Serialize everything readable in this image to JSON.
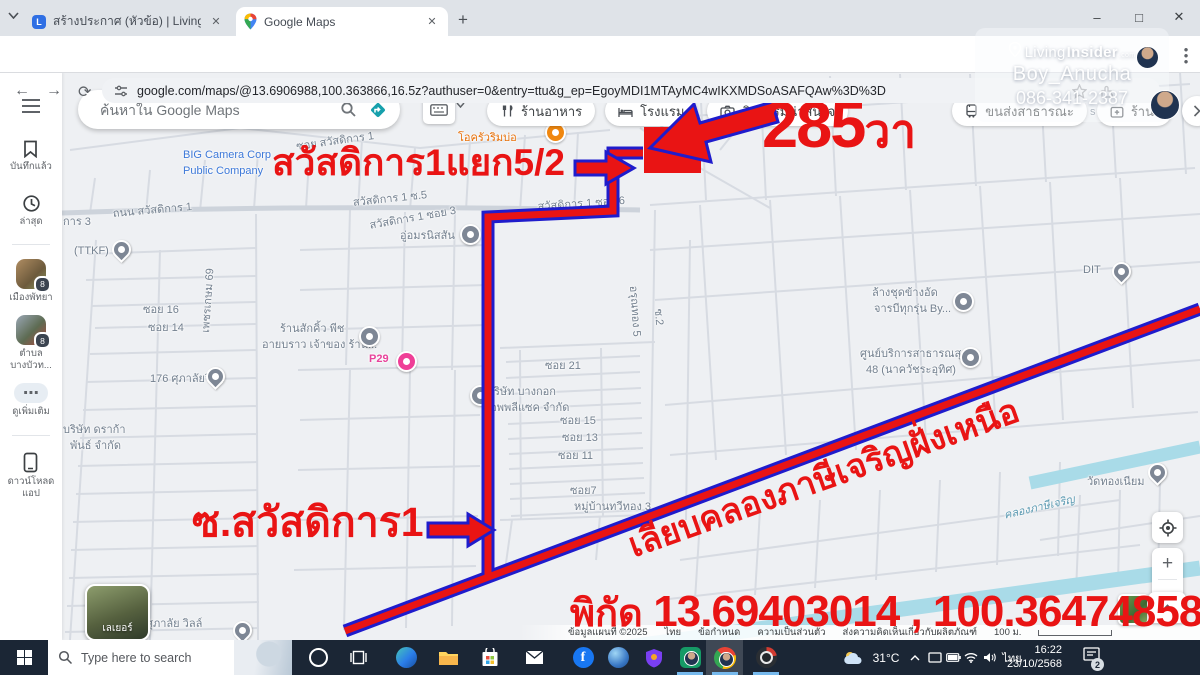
{
  "browser": {
    "tabs": [
      {
        "title": "สร้างประกาศ (หัวข้อ) | Livinginside"
      },
      {
        "title": "Google Maps"
      }
    ],
    "url": "google.com/maps/@13.6906988,100.363866,16.5z?authuser=0&entry=ttu&g_ep=EgoyMDI1MTAyMC4wIKXMDSoASAFQAw%3D%3D",
    "glyphs": {
      "min": "–",
      "max": "□",
      "close": "✕",
      "newtab": "+",
      "tab_close": "✕",
      "back": "←",
      "forward": "→",
      "reload": "⟳"
    }
  },
  "watermark": {
    "brand_prefix": "Living",
    "brand_suffix": "Insider",
    "brand_tld": ".com",
    "user": "Boy_Anucha",
    "phone": "086-341-2387"
  },
  "maps": {
    "search_placeholder": "ค้นหาใน Google Maps",
    "chips": [
      {
        "label": "ร้านอาหาร",
        "icon": "restaurant"
      },
      {
        "label": "โรงแรม",
        "icon": "hotel"
      },
      {
        "label": "กิจกรรมน่าสนใจ",
        "icon": "camera"
      },
      {
        "label": "ขนส่งสาธารณะ",
        "icon": "transit"
      },
      {
        "label": "ร้านขายยา",
        "icon": "pharmacy"
      }
    ],
    "sidebar": {
      "items": [
        {
          "l1": "บันทึกแล้ว"
        },
        {
          "l1": "ล่าสุด"
        },
        {
          "l1": "เมืองพัทยา",
          "badge": "8"
        },
        {
          "l1": "ตำบล",
          "l2": "บางบัวท...",
          "badge": "8"
        },
        {
          "l1": "ดูเพิ่มเติม"
        },
        {
          "l1": "ดาวน์โหลด",
          "l2": "แอป"
        }
      ]
    },
    "layers_label": "เลเยอร์",
    "zoom_in": "+",
    "zoom_out": "−",
    "attribution": [
      "ข้อมูลแผนที่ ©2025",
      "ไทย",
      "ข้อกำหนด",
      "ความเป็นส่วนตัว",
      "ส่งความคิดเห็นเกี่ยวกับผลิตภัณฑ์"
    ],
    "scale_label": "100 ม.",
    "labels": [
      {
        "t": "โอครัวริมบ่อ",
        "x": 458,
        "y": 128,
        "c": "orange"
      },
      {
        "t": "BIG Camera Corp",
        "x": 183,
        "y": 149,
        "c": "blue"
      },
      {
        "t": "Public Company",
        "x": 183,
        "y": 165,
        "c": "blue"
      },
      {
        "t": "ซอย สวัสดิการ 1",
        "x": 295,
        "y": 137,
        "c": "gray",
        "r": -8
      },
      {
        "t": "ถนน สวัสดิการ 1",
        "x": 112,
        "y": 204,
        "c": "gray",
        "r": -5
      },
      {
        "t": "ิการ 3",
        "x": 63,
        "y": 212,
        "c": "gray"
      },
      {
        "t": "สวัสดิการ 1 ซ.5",
        "x": 352,
        "y": 193,
        "c": "gray",
        "r": -6
      },
      {
        "t": "สวัสดิการ 1 ซอย 6",
        "x": 537,
        "y": 197,
        "c": "gray",
        "r": -4
      },
      {
        "t": "สวัสดิการ 1 ซอย 3",
        "x": 368,
        "y": 216,
        "c": "gray",
        "r": -10
      },
      {
        "t": "อู่อมรนิสสัน",
        "x": 400,
        "y": 226,
        "c": "gray"
      },
      {
        "t": "(TTKF)",
        "x": 74,
        "y": 245,
        "c": "gray"
      },
      {
        "t": "ซอย 16",
        "x": 143,
        "y": 300,
        "c": "gray"
      },
      {
        "t": "ซอย 14",
        "x": 148,
        "y": 318,
        "c": "gray"
      },
      {
        "t": "เพชรเกษม 69",
        "x": 196,
        "y": 332,
        "c": "gray",
        "r": -86
      },
      {
        "t": "ร้านสักคิ้ว พีช",
        "x": 280,
        "y": 319,
        "c": "gray"
      },
      {
        "t": "อายบราว เจ้าของ ร้าน...",
        "x": 262,
        "y": 335,
        "c": "gray"
      },
      {
        "t": "176 ศุภาลัยวิลล์",
        "x": 150,
        "y": 369,
        "c": "gray"
      },
      {
        "t": "P29",
        "x": 369,
        "y": 353,
        "c": "pink"
      },
      {
        "t": "บริษัท บางกอก",
        "x": 487,
        "y": 382,
        "c": "gray"
      },
      {
        "t": "แอพพลีแซค จำกัด",
        "x": 483,
        "y": 398,
        "c": "gray"
      },
      {
        "t": "บริษัท ดราก้า",
        "x": 63,
        "y": 420,
        "c": "gray"
      },
      {
        "t": "พันธ์ จำกัด",
        "x": 70,
        "y": 436,
        "c": "gray"
      },
      {
        "t": "ซอย 21",
        "x": 545,
        "y": 356,
        "c": "gray"
      },
      {
        "t": "ซอย 15",
        "x": 560,
        "y": 411,
        "c": "gray"
      },
      {
        "t": "ซอย 13",
        "x": 562,
        "y": 428,
        "c": "gray"
      },
      {
        "t": "ซอย 11",
        "x": 558,
        "y": 446,
        "c": "gray"
      },
      {
        "t": "ซอย7",
        "x": 570,
        "y": 481,
        "c": "gray"
      },
      {
        "t": "หมู่บ้านทวีทอง 3",
        "x": 574,
        "y": 497,
        "c": "gray"
      },
      {
        "t": "อรุณทอง 5",
        "x": 643,
        "y": 285,
        "c": "gray",
        "r": 86
      },
      {
        "t": "ซ.2",
        "x": 668,
        "y": 308,
        "c": "gray",
        "r": 86
      },
      {
        "t": "ล้างชุดข้างอัด",
        "x": 872,
        "y": 283,
        "c": "gray"
      },
      {
        "t": "จารบีทุกรุ่น By...",
        "x": 874,
        "y": 299,
        "c": "gray"
      },
      {
        "t": "DIT",
        "x": 1083,
        "y": 264,
        "c": "gray"
      },
      {
        "t": "ศูนย์บริการสาธารณสุข",
        "x": 860,
        "y": 344,
        "c": "gray"
      },
      {
        "t": "48 (นาควัชระอุทิศ)",
        "x": 866,
        "y": 360,
        "c": "gray"
      },
      {
        "t": "วัดทองเนียม",
        "x": 1087,
        "y": 472,
        "c": "gray"
      },
      {
        "t": "คลองภาษีเจริญ",
        "x": 1002,
        "y": 506,
        "c": "water",
        "r": -13
      },
      {
        "t": "ศุภาลัย วิลล์",
        "x": 146,
        "y": 614,
        "c": "gray"
      },
      {
        "t": "AP Premium",
        "x": 1080,
        "y": 91,
        "c": "gray"
      },
      {
        "t": "s Coating",
        "x": 1090,
        "y": 106,
        "c": "gray"
      }
    ],
    "pins": [
      {
        "x": 545,
        "y": 122,
        "t": "orange"
      },
      {
        "x": 460,
        "y": 224,
        "t": "gray"
      },
      {
        "x": 112,
        "y": 240,
        "t": "drop"
      },
      {
        "x": 359,
        "y": 326,
        "t": "gray"
      },
      {
        "x": 206,
        "y": 367,
        "t": "drop"
      },
      {
        "x": 396,
        "y": 351,
        "t": "pink"
      },
      {
        "x": 470,
        "y": 385,
        "t": "gray"
      },
      {
        "x": 953,
        "y": 291,
        "t": "gray"
      },
      {
        "x": 1112,
        "y": 262,
        "t": "drop"
      },
      {
        "x": 960,
        "y": 347,
        "t": "gray"
      },
      {
        "x": 1148,
        "y": 463,
        "t": "drop"
      },
      {
        "x": 233,
        "y": 621,
        "t": "drop"
      }
    ]
  },
  "annotations": {
    "area_number": "285",
    "area_unit": "วา",
    "junction_label": "สวัสดิการ1แยก5/2",
    "soi_label": "ซ.สวัสดิการ1",
    "canal_road_label": "เลียบคลองภาษีเจริญฝั่งเหนือ",
    "coords_prefix": "พิกัด ",
    "coords_value": "13.69403014 , 100.36474858",
    "red": "#e91414",
    "blue": "#1f1ccc"
  },
  "taskbar": {
    "search_placeholder": "Type here to search",
    "temp": "31°C",
    "lang": "ไทย",
    "time": "16:22",
    "date": "23/10/2568",
    "badge": "2"
  }
}
